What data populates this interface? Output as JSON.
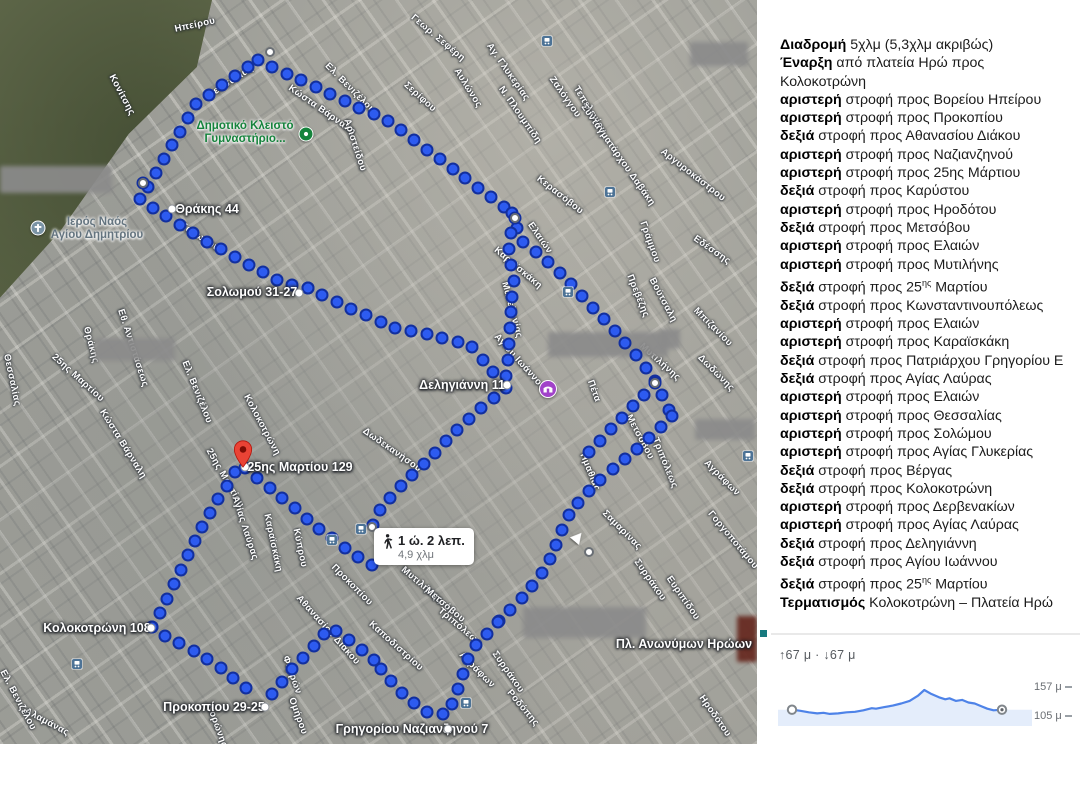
{
  "map": {
    "time_bubble": {
      "time": "1 ώ. 2 λεπ.",
      "distance": "4,9 χλμ",
      "x": 374,
      "y": 528
    },
    "red_pin": {
      "x": 243,
      "y": 468
    },
    "address_labels": [
      {
        "text": "Θράκης 44",
        "x": 207,
        "y": 209,
        "dot_x": 172,
        "dot_y": 209
      },
      {
        "text": "Σολωμού 31-27",
        "x": 252,
        "y": 292,
        "dot_x": 299,
        "dot_y": 293
      },
      {
        "text": "Δεληγιάννη 11",
        "x": 462,
        "y": 385,
        "dot_x": 507,
        "dot_y": 385
      },
      {
        "text": "25ης Μαρτίου 129",
        "x": 300,
        "y": 467,
        "dot_x": 245,
        "dot_y": 467
      },
      {
        "text": "Κολοκοτρώνη 108",
        "x": 97,
        "y": 628,
        "dot_x": 151,
        "dot_y": 628
      },
      {
        "text": "Προκοπίου 29-25",
        "x": 214,
        "y": 707,
        "dot_x": 265,
        "dot_y": 707
      },
      {
        "text": "Γρηγορίου\nΝαζιανζηνού 7",
        "x": 412,
        "y": 729,
        "dot_x": 448,
        "dot_y": 729
      },
      {
        "text": "Πλ. Ανωνύμων\nΗρώων",
        "x": 684,
        "y": 644,
        "dot_x": null,
        "dot_y": null
      }
    ],
    "pois": [
      {
        "kind": "sports-complex",
        "label": "Δημοτικό Κλειστό\nΓυμναστήριο...",
        "label_color": "#15833c",
        "lx": 245,
        "ly": 133,
        "cx": 306,
        "cy": 134,
        "color": "#15833c",
        "size": 15
      },
      {
        "kind": "church",
        "label": "Ιερός Ναός\nΑγίου Δημητρίου",
        "label_color": "#64747f",
        "lx": 97,
        "ly": 229,
        "cx": 38,
        "cy": 228,
        "color": "#7a93a5",
        "size": 15
      },
      {
        "kind": "place-of-worship",
        "label": "",
        "label_color": "#a142c9",
        "lx": null,
        "ly": null,
        "cx": 548,
        "cy": 389,
        "color": "#a142c9",
        "size": 18
      }
    ],
    "transit_stops": [
      [
        547,
        41
      ],
      [
        610,
        192
      ],
      [
        568,
        292
      ],
      [
        361,
        529
      ],
      [
        332,
        540
      ],
      [
        77,
        664
      ],
      [
        466,
        703
      ],
      [
        748,
        456
      ]
    ],
    "streets": [
      {
        "t": "Ηπείρου",
        "x": 195,
        "y": 25,
        "r": -12
      },
      {
        "t": "Θεσσαλίας",
        "x": 230,
        "y": 82,
        "r": -33
      },
      {
        "t": "Κονίτσης",
        "x": 122,
        "y": 95,
        "r": 62
      },
      {
        "t": "Κώστα Βάρναλη",
        "x": 322,
        "y": 110,
        "r": 35
      },
      {
        "t": "Γεωρ. Σεφέρη",
        "x": 438,
        "y": 38,
        "r": 40
      },
      {
        "t": "Σερίφου",
        "x": 420,
        "y": 97,
        "r": 42
      },
      {
        "t": "Αυλώνος",
        "x": 468,
        "y": 88,
        "r": 58
      },
      {
        "t": "Αγ. Γλυκερίας",
        "x": 508,
        "y": 72,
        "r": 55
      },
      {
        "t": "Ν. Πλουμπίδη",
        "x": 520,
        "y": 115,
        "r": 55
      },
      {
        "t": "Ζαλόγγου",
        "x": 565,
        "y": 97,
        "r": 55
      },
      {
        "t": "Τεπελενίου",
        "x": 590,
        "y": 110,
        "r": 58
      },
      {
        "t": "Κερασόβου",
        "x": 560,
        "y": 195,
        "r": 38
      },
      {
        "t": "Συνταγματάρχου Δαβάκη",
        "x": 618,
        "y": 155,
        "r": 55
      },
      {
        "t": "Αργυροκάστρου",
        "x": 693,
        "y": 175,
        "r": 38
      },
      {
        "t": "Γράμμου",
        "x": 650,
        "y": 242,
        "r": 70
      },
      {
        "t": "Εδέσσης",
        "x": 712,
        "y": 250,
        "r": 35
      },
      {
        "t": "Αριστείδου",
        "x": 355,
        "y": 145,
        "r": 72
      },
      {
        "t": "Ελ. Βενιζέλου",
        "x": 350,
        "y": 88,
        "r": 45
      },
      {
        "t": "Σολωμού",
        "x": 200,
        "y": 237,
        "r": 33
      },
      {
        "t": "Θράκης",
        "x": 91,
        "y": 345,
        "r": 75
      },
      {
        "t": "25ης Μαρτίου",
        "x": 78,
        "y": 378,
        "r": 42
      },
      {
        "t": "Εθ. Αντιστάσεως",
        "x": 133,
        "y": 348,
        "r": 72
      },
      {
        "t": "Ελ. Βενιζέλου",
        "x": 197,
        "y": 392,
        "r": 68
      },
      {
        "t": "Κώστα Βάρναλη",
        "x": 123,
        "y": 444,
        "r": 58
      },
      {
        "t": "Κολοκοτρώνη",
        "x": 262,
        "y": 425,
        "r": 62
      },
      {
        "t": "Μακεδονίας",
        "x": 512,
        "y": 310,
        "r": 75
      },
      {
        "t": "Καραϊσκάκη",
        "x": 518,
        "y": 268,
        "r": 40
      },
      {
        "t": "Ελαιών",
        "x": 540,
        "y": 238,
        "r": 55
      },
      {
        "t": "Πρεβέζης",
        "x": 638,
        "y": 296,
        "r": 68
      },
      {
        "t": "Βούτσαλη",
        "x": 663,
        "y": 300,
        "r": 62
      },
      {
        "t": "Μπιζανίου",
        "x": 713,
        "y": 327,
        "r": 45
      },
      {
        "t": "Μυτιλήνης",
        "x": 660,
        "y": 362,
        "r": 42
      },
      {
        "t": "Δωδώνης",
        "x": 716,
        "y": 373,
        "r": 45
      },
      {
        "t": "Πέτα",
        "x": 594,
        "y": 391,
        "r": 70
      },
      {
        "t": "Μετσόβου",
        "x": 640,
        "y": 437,
        "r": 62
      },
      {
        "t": "Τριπόλεως",
        "x": 665,
        "y": 463,
        "r": 68
      },
      {
        "t": "Ημαθίας",
        "x": 590,
        "y": 472,
        "r": 68
      },
      {
        "t": "Αγράφων",
        "x": 722,
        "y": 478,
        "r": 45
      },
      {
        "t": "Αγίου Ιωάννου",
        "x": 520,
        "y": 362,
        "r": 48
      },
      {
        "t": "Δωδεκανήσου",
        "x": 392,
        "y": 450,
        "r": 35
      },
      {
        "t": "25ης Μαρτίου",
        "x": 225,
        "y": 478,
        "r": 60
      },
      {
        "t": "Αγίας Λαύρας",
        "x": 245,
        "y": 528,
        "r": 72
      },
      {
        "t": "Καραϊσκάκη",
        "x": 273,
        "y": 543,
        "r": 78
      },
      {
        "t": "Κύπρου",
        "x": 300,
        "y": 548,
        "r": 78
      },
      {
        "t": "Σαμαρίνας",
        "x": 622,
        "y": 530,
        "r": 45
      },
      {
        "t": "Γοργοποτάμου",
        "x": 733,
        "y": 540,
        "r": 50
      },
      {
        "t": "Συρράκου",
        "x": 650,
        "y": 580,
        "r": 55
      },
      {
        "t": "Ευριπίδου",
        "x": 683,
        "y": 598,
        "r": 55
      },
      {
        "t": "Μυτιλήνης",
        "x": 422,
        "y": 585,
        "r": 40
      },
      {
        "t": "Μετσόβου",
        "x": 445,
        "y": 605,
        "r": 40
      },
      {
        "t": "Τριπόλεως",
        "x": 460,
        "y": 627,
        "r": 40
      },
      {
        "t": "Αγράφων",
        "x": 477,
        "y": 670,
        "r": 45
      },
      {
        "t": "Καποδιστρίου",
        "x": 396,
        "y": 646,
        "r": 42
      },
      {
        "t": "Συρράκου",
        "x": 508,
        "y": 672,
        "r": 55
      },
      {
        "t": "Ροδόπης",
        "x": 523,
        "y": 708,
        "r": 50
      },
      {
        "t": "Ηροδότου",
        "x": 715,
        "y": 716,
        "r": 55
      },
      {
        "t": "Αθανασίου Διάκου",
        "x": 328,
        "y": 630,
        "r": 48
      },
      {
        "t": "Προκοπίου",
        "x": 352,
        "y": 585,
        "r": 45
      },
      {
        "t": "Φερρών",
        "x": 292,
        "y": 675,
        "r": 70
      },
      {
        "t": "Ομήρου",
        "x": 298,
        "y": 716,
        "r": 70
      },
      {
        "t": "Κορώνης",
        "x": 217,
        "y": 726,
        "r": 70
      },
      {
        "t": "Αλαμάνας",
        "x": 47,
        "y": 722,
        "r": 28
      },
      {
        "t": "Ελ. Βενιζέλου",
        "x": 18,
        "y": 700,
        "r": 62
      },
      {
        "t": "Θεσσαλίας",
        "x": 12,
        "y": 380,
        "r": 78
      }
    ],
    "blurs": [
      {
        "x": 0,
        "y": 166,
        "w": 112,
        "h": 27,
        "red": false
      },
      {
        "x": 95,
        "y": 338,
        "w": 80,
        "h": 23,
        "red": false
      },
      {
        "x": 690,
        "y": 42,
        "w": 58,
        "h": 24,
        "red": false
      },
      {
        "x": 548,
        "y": 332,
        "w": 120,
        "h": 25,
        "red": false
      },
      {
        "x": 695,
        "y": 419,
        "w": 60,
        "h": 21,
        "red": false
      },
      {
        "x": 523,
        "y": 607,
        "w": 123,
        "h": 31,
        "red": false
      },
      {
        "x": 660,
        "y": 329,
        "w": 20,
        "h": 20,
        "red": false
      },
      {
        "x": 737,
        "y": 616,
        "w": 20,
        "h": 46,
        "red": true
      }
    ],
    "route": {
      "dot_spacing": 16,
      "segments": [
        [
          [
            148,
            187
          ],
          [
            196,
            104
          ],
          [
            258,
            60
          ]
        ],
        [
          [
            258,
            60
          ],
          [
            390,
            122
          ],
          [
            512,
            213
          ]
        ],
        [
          [
            512,
            213
          ],
          [
            520,
            240
          ],
          [
            556,
            268
          ],
          [
            600,
            315
          ],
          [
            640,
            360
          ],
          [
            655,
            381
          ],
          [
            672,
            416
          ]
        ],
        [
          [
            672,
            416
          ],
          [
            640,
            447
          ],
          [
            596,
            483
          ],
          [
            570,
            512
          ],
          [
            545,
            570
          ],
          [
            520,
            600
          ],
          [
            498,
            622
          ]
        ],
        [
          [
            498,
            622
          ],
          [
            470,
            652
          ],
          [
            458,
            690
          ],
          [
            448,
            714
          ],
          [
            425,
            712
          ],
          [
            398,
            690
          ],
          [
            374,
            660
          ]
        ],
        [
          [
            374,
            660
          ],
          [
            352,
            642
          ],
          [
            330,
            627
          ],
          [
            315,
            645
          ],
          [
            294,
            667
          ],
          [
            275,
            690
          ],
          [
            266,
            703
          ]
        ],
        [
          [
            152,
            627
          ],
          [
            165,
            636
          ],
          [
            192,
            650
          ],
          [
            217,
            665
          ],
          [
            242,
            685
          ],
          [
            258,
            697
          ]
        ],
        [
          [
            152,
            627
          ],
          [
            168,
            597
          ],
          [
            183,
            565
          ],
          [
            200,
            530
          ],
          [
            220,
            496
          ],
          [
            240,
            464
          ]
        ],
        [
          [
            245,
            468
          ],
          [
            270,
            488
          ],
          [
            300,
            513
          ],
          [
            330,
            537
          ],
          [
            360,
            558
          ],
          [
            382,
            572
          ]
        ],
        [
          [
            143,
            183
          ],
          [
            140,
            200
          ],
          [
            160,
            212
          ],
          [
            200,
            238
          ],
          [
            226,
            252
          ],
          [
            252,
            267
          ],
          [
            284,
            283
          ],
          [
            308,
            288
          ]
        ],
        [
          [
            308,
            288
          ],
          [
            350,
            308
          ],
          [
            395,
            328
          ],
          [
            420,
            332
          ],
          [
            470,
            345
          ],
          [
            500,
            380
          ]
        ],
        [
          [
            506,
            388
          ],
          [
            483,
            407
          ],
          [
            462,
            425
          ],
          [
            438,
            450
          ],
          [
            415,
            472
          ],
          [
            395,
            492
          ],
          [
            378,
            512
          ],
          [
            372,
            527
          ]
        ],
        [
          [
            515,
            218
          ],
          [
            508,
            245
          ],
          [
            514,
            280
          ],
          [
            510,
            320
          ],
          [
            508,
            355
          ],
          [
            506,
            383
          ]
        ],
        [
          [
            655,
            383
          ],
          [
            630,
            410
          ],
          [
            605,
            435
          ],
          [
            580,
            462
          ]
        ]
      ],
      "waypoints": [
        [
          143,
          183
        ],
        [
          270,
          52
        ],
        [
          515,
          218
        ],
        [
          655,
          383
        ],
        [
          589,
          552
        ],
        [
          372,
          527
        ]
      ]
    }
  },
  "panel": {
    "directions": [
      {
        "b": "Διαδρομή",
        "t": " 5χλμ (5,3χλμ ακριβώς)"
      },
      {
        "b": "Έναρξη",
        "t": " από πλατεία Ηρώ προς",
        "line2": "Κολοκοτρώνη"
      },
      {
        "b": "αριστερή",
        "t": " στροφή προς Βορείου Ηπείρου"
      },
      {
        "b": "αριστερή",
        "t": " στροφή προς Προκοπίου"
      },
      {
        "b": "δεξιά",
        "t": " στροφή προς Αθανασίου Διάκου"
      },
      {
        "b": "αριστερή",
        "t": " στροφή προς Ναζιανζηνού"
      },
      {
        "b": "αριστερή",
        "t": " στροφή προς 25ης Μάρτιου"
      },
      {
        "b": "δεξιά",
        "t": " στροφή προς Καρύστου"
      },
      {
        "b": "αριστερή",
        "t": " στροφή προς Ηροδότου"
      },
      {
        "b": "δεξιά",
        "t": " στροφή προς Μετσόβου"
      },
      {
        "b": "αριστερή",
        "t": " στροφή προς Ελαιών"
      },
      {
        "b": "αριστερή",
        "t": " στροφή προς Μυτιλήνης"
      },
      {
        "b": "δεξιά",
        "t": " στροφή προς 25",
        "sup": "ης",
        "t2": " Μαρτίου"
      },
      {
        "b": "δεξιά",
        "t": " στροφή προς Κωνσταντινουπόλεως"
      },
      {
        "b": "αριστερή",
        "t": " στροφή προς Ελαιών"
      },
      {
        "b": "αριστερή",
        "t": " στροφή προς Καραϊσκάκη"
      },
      {
        "b": "δεξιά",
        "t": " στροφή προς Πατριάρχου Γρηγορίου Ε"
      },
      {
        "b": "δεξιά",
        "t": " στροφή προς Αγίας Λαύρας"
      },
      {
        "b": "αριστερή",
        "t": " στροφή προς Ελαιών"
      },
      {
        "b": "αριστερή",
        "t": " στροφή προς Θεσσαλίας"
      },
      {
        "b": "αριστερή",
        "t": " στροφή προς Σολώμου"
      },
      {
        "b": "αριστερή",
        "t": " στροφή προς Αγίας Γλυκερίας"
      },
      {
        "b": "δεξιά",
        "t": " στροφή προς Βέργας"
      },
      {
        "b": "δεξιά",
        "t": " στροφή προς Κολοκοτρώνη"
      },
      {
        "b": "αριστερή",
        "t": " στροφή προς Δερβενακίων"
      },
      {
        "b": "αριστερή",
        "t": " στροφή προς Αγίας Λαύρας"
      },
      {
        "b": "δεξιά",
        "t": " στροφή προς Δεληγιάννη"
      },
      {
        "b": "δεξιά",
        "t": " στροφή προς Αγίου Ιωάννου"
      },
      {
        "b": "δεξιά",
        "t": " στροφή προς 25",
        "sup": "ης",
        "t2": " Μαρτίου"
      },
      {
        "b": "Τερματισμός",
        "t": " Κολοκοτρώνη – Πλατεία Ηρώ"
      }
    ]
  },
  "elevation": {
    "stats": "↑67 μ  ·  ↓67 μ"
  },
  "chart_data": {
    "type": "area",
    "x_fraction": [
      0,
      0.04,
      0.08,
      0.12,
      0.15,
      0.18,
      0.22,
      0.26,
      0.3,
      0.34,
      0.38,
      0.4,
      0.44,
      0.48,
      0.52,
      0.56,
      0.6,
      0.63,
      0.66,
      0.7,
      0.73,
      0.75,
      0.78,
      0.81,
      0.84,
      0.87,
      0.9,
      0.93,
      0.96,
      1.0
    ],
    "elevation_m": [
      119,
      117,
      114,
      112,
      113,
      111,
      112,
      114,
      115,
      118,
      122,
      121,
      124,
      127,
      131,
      136,
      146,
      157,
      150,
      143,
      139,
      141,
      136,
      138,
      133,
      131,
      126,
      121,
      118,
      119
    ],
    "ascent_m": 67,
    "descent_m": 67,
    "y_axis_labels": [
      "157 μ",
      "105 μ"
    ],
    "y_range": [
      105,
      157
    ],
    "line_color": "#4e83e8",
    "fill_color": "#e4edfb",
    "legend": "none",
    "grid": "right ticks only"
  }
}
